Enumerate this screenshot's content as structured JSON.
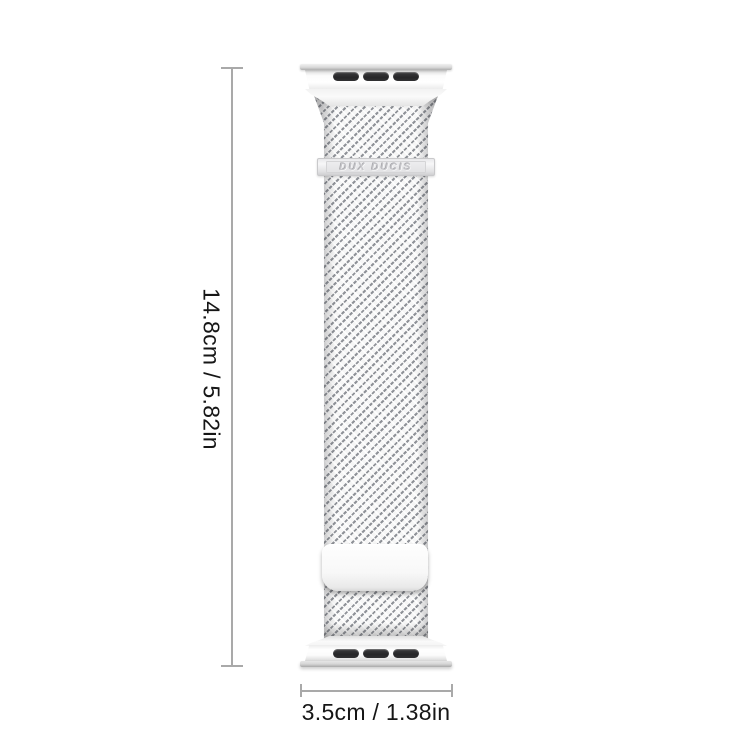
{
  "product": {
    "brand_label": "DUX DUCIS",
    "band_style": "milanese-mesh-loop",
    "connector_slots_per_end": 3
  },
  "dimensions": {
    "height": {
      "label": "14.8cm / 5.82in"
    },
    "width": {
      "label": "3.5cm / 1.38in"
    }
  },
  "icons": {
    "connector_slot": "dark-rounded-pill-cutout",
    "dimension_marker": "line-with-end-ticks"
  },
  "colors": {
    "background": "#ffffff",
    "dimension_line": "#a9a9a9",
    "label_text": "#161616",
    "band_silver_light": "#f6f6f6",
    "mesh_stroke": "#8f9298",
    "connector_slot": "#2a2a2c",
    "brand_text_embossed": "#c6c6ca"
  }
}
